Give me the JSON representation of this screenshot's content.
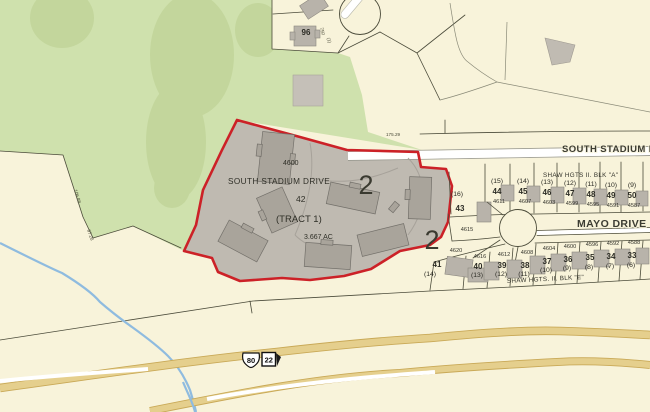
{
  "colors": {
    "background": "#f8f3da",
    "vegetation": "#cfe1ad",
    "vegetation_dark": "#c3d69c",
    "tract_fill": "#bfbab1",
    "tract_border": "#cc2127",
    "building": "#a9a49b",
    "highway": "#e5cf8d",
    "stream": "#8fbbdf",
    "parcel_line": "#4b4b3a"
  },
  "tract": {
    "address": "4600",
    "street": "SOUTH STADIUM DRIVE",
    "lot": "42",
    "name": "(TRACT 1)",
    "area": "3.667 AC",
    "zone_left": "2",
    "zone_right": "2"
  },
  "streets": {
    "south_stadium": "SOUTH STADIUM D",
    "mayo": "MAYO DRIVE"
  },
  "blocks": {
    "a_label": "SHAW HGTS II.  BLK \"A\"",
    "e_label": "SHAW HGTS. II.  BLK \"E\""
  },
  "north_parcel": {
    "lot": "96",
    "dim_a": "750",
    "dim_b": "(1)"
  },
  "corner_lots": {
    "west_paren": "(16)",
    "west_lot": "43",
    "south_addr": "4615",
    "sw_addr": "4620",
    "sw_lot": "41",
    "sw_paren": "(14)"
  },
  "block_a_lots": [
    {
      "paren": "(15)",
      "lot": "44",
      "addr": "4611"
    },
    {
      "paren": "(14)",
      "lot": "45",
      "addr": "4607"
    },
    {
      "paren": "(13)",
      "lot": "46",
      "addr": "4603"
    },
    {
      "paren": "(12)",
      "lot": "47",
      "addr": "4599"
    },
    {
      "paren": "(11)",
      "lot": "48",
      "addr": "4595"
    },
    {
      "paren": "(10)",
      "lot": "49",
      "addr": "4591"
    },
    {
      "paren": "(9)",
      "lot": "50",
      "addr": "4587"
    }
  ],
  "block_e_lots": [
    {
      "addr": "4616",
      "lot": "40",
      "paren": "(13)"
    },
    {
      "addr": "4612",
      "lot": "39",
      "paren": "(12)"
    },
    {
      "addr": "4608",
      "lot": "38",
      "paren": "(11)"
    },
    {
      "addr": "4604",
      "lot": "37",
      "paren": "(10)"
    },
    {
      "addr": "4600",
      "lot": "36",
      "paren": "(9)"
    },
    {
      "addr": "4596",
      "lot": "35",
      "paren": "(8)"
    },
    {
      "addr": "4592",
      "lot": "34",
      "paren": "(7)"
    },
    {
      "addr": "4588",
      "lot": "33",
      "paren": "(6)"
    }
  ],
  "dimensions": {
    "d1": "106.88",
    "d2": "97.28",
    "d3": "175.29"
  },
  "route_shields": {
    "us": "80",
    "state": "22"
  }
}
